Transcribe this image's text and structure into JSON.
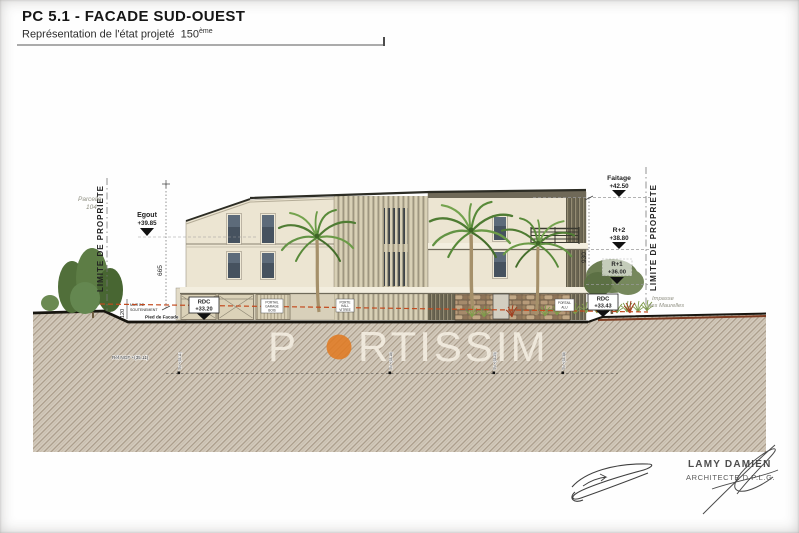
{
  "header": {
    "title": "PC 5.1 - FACADE SUD-OUEST",
    "subtitle": "Représentation de l'état projeté",
    "scale_number": "150",
    "scale_suffix": "ème"
  },
  "watermark": {
    "prefix": "P",
    "suffix": "RTISSIM"
  },
  "palette": {
    "logo_orange": "#e2791f",
    "level_red": "#c34a1e",
    "facade_cream": "#ece5d2",
    "ground_base": "#d3cabc",
    "roof_dark": "#2c2c24",
    "window_glass": "#46525f",
    "stone_brown": "#a58a6b",
    "palm_green": "#5f8f3d"
  },
  "levels": {
    "egout": {
      "label": "Egout",
      "value": "+39.85"
    },
    "faitage": {
      "label": "Faitage",
      "value": "+42.50"
    },
    "r2": {
      "label": "R+2",
      "value": "+38.80"
    },
    "r1": {
      "label": "R+1",
      "value": "+36.00"
    },
    "rdc_left": {
      "label": "RDC",
      "value": "+33.20"
    },
    "rdc_right": {
      "label": "RDC",
      "value": "+33.43"
    }
  },
  "dimensions": {
    "height_left": "665",
    "height_right": "930",
    "retaining_wall": "120"
  },
  "site": {
    "property_limit_left": "LIMITE DE PROPRIETE",
    "property_limit_right": "LIMITE DE PROPRIETE",
    "parcel_line1": "Parcelle",
    "parcel_line2": "104",
    "street_line1": "Impasse",
    "street_line2": "des Maurelles",
    "retaining_wall_line1": "MUR DE",
    "retaining_wall_line2": "SOUTENEMENT",
    "facade_foot": "Pied de Facade",
    "ngf_ref": "Réf NGF +(35.11)",
    "tn_marks": [
      "TN +(33.11)",
      "TN +(33.18)",
      "TN +(33.25)",
      "TN +(33.38)"
    ]
  },
  "facade_labels": {
    "garage": [
      "PORTAIL",
      "GARAGE",
      "BOIS"
    ],
    "hall": [
      "PORTE",
      "HALL",
      "VITREE"
    ],
    "gate": [
      "PORTAIL",
      "ALU"
    ]
  },
  "stamp": {
    "architect_name": "LAMY DAMIEN",
    "architect_title": "ARCHITECTE D.P.L.G."
  }
}
